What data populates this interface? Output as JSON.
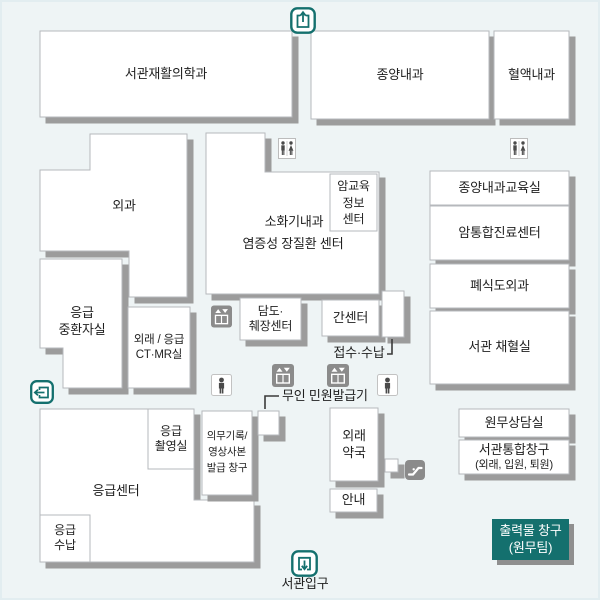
{
  "map": {
    "rooms": {
      "rehab": "서관재활의학과",
      "oncology": "종양내과",
      "hematology": "혈액내과",
      "surgery": "외과",
      "er_icu": "응급\n중환자실",
      "ct_mr": "외래 / 응급\nCT·MR실",
      "gastro": "소화기내과",
      "ibd_center": "염증성 장질환 센터",
      "cancer_edu": "암교육\n정보\n센터",
      "biliary": "담도·\n췌장센터",
      "liver": "간센터",
      "onc_edu_room": "종양내과교육실",
      "cancer_integrated": "암통합진료센터",
      "lung_eso": "폐식도외과",
      "blood_room": "서관 채혈실",
      "er_center": "응급센터",
      "er_xray": "응급\n촬영실",
      "er_pay": "응급\n수납",
      "records": "의무기록/\n영상사본\n발급 창구",
      "pharmacy": "외래\n약국",
      "info_desk": "안내",
      "admin_office": "원무상담실",
      "integrated_desk_line1": "서관통합창구",
      "integrated_desk_line2": "(외래, 입원, 퇴원)",
      "print_desk": "출력물 창구\n(원무팀)"
    },
    "labels": {
      "reception": "접수·수납",
      "kiosk": "무인 민원발급기",
      "entrance": "서관입구"
    },
    "icons": {
      "top_exit": "door-exit-up-icon",
      "left_exit": "door-exit-left-icon",
      "bottom_entrance": "door-entrance-down-icon",
      "restroom_center": "restroom-icon",
      "restroom_right": "restroom-icon",
      "elevator_upper": "elevator-icon",
      "elevator_left": "elevator-icon",
      "elevator_right": "elevator-icon",
      "person_left": "person-icon",
      "person_right": "person-icon",
      "escalator": "escalator-icon"
    },
    "colors": {
      "background": "#eef4f5",
      "room_fill": "#ffffff",
      "room_border": "#b6b8bc",
      "shadow": "#9c9c9c",
      "teal": "#14706e",
      "icon_gray": "#8b8b8b",
      "text": "#1f1f1f"
    }
  }
}
